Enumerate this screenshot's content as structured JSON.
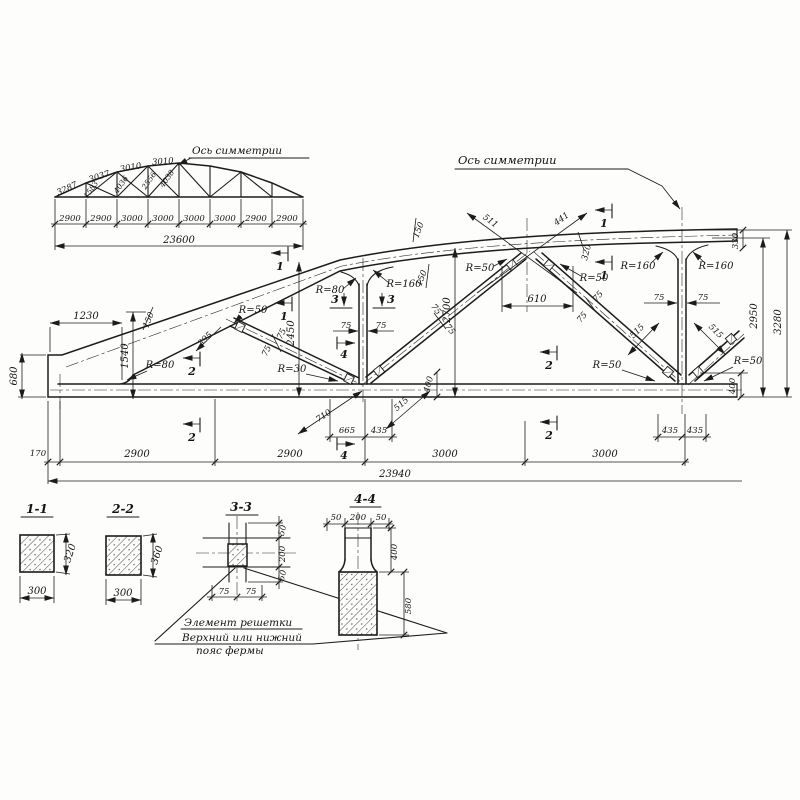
{
  "overview": {
    "axis_label": "Ось симметрии",
    "top_dims": [
      "3287",
      "3037",
      "3010",
      "3010"
    ],
    "diag_dims": [
      "1583",
      "4036",
      "2556",
      "4038"
    ],
    "bottom_dims": [
      "2900",
      "2900",
      "3000",
      "3000",
      "3000",
      "3000",
      "2900",
      "2900"
    ],
    "total": "23600"
  },
  "main": {
    "axis_label": "Ось симметрии",
    "dims": {
      "d1230": "1230",
      "d1540": "1540",
      "d150": "150",
      "d680": "680",
      "d170": "170",
      "d2900": "2900",
      "d3000": "3000",
      "total": "23940",
      "d2450": "2450",
      "d2700": "2700",
      "d2950": "2950",
      "d3280": "3280",
      "d610": "610",
      "d511": "511",
      "d441": "441",
      "d395": "395",
      "d710": "710",
      "d665": "665",
      "d435": "435",
      "d515": "515",
      "d400": "400",
      "d320": "320",
      "d330": "330",
      "d75": "75",
      "r30": "R=30",
      "r50": "R=50",
      "r80": "R=80",
      "r160": "R=160"
    },
    "marks": {
      "s1": "1",
      "s2": "2",
      "s3": "3",
      "s4": "4"
    }
  },
  "sections": {
    "s11": {
      "title": "1-1",
      "w": "300",
      "h": "320"
    },
    "s22": {
      "title": "2-2",
      "w": "300",
      "h": "360"
    },
    "s33": {
      "title": "3-3",
      "d50": "50",
      "d200": "200",
      "d75": "75",
      "note1": "Элемент решетки",
      "note2": "Верхний или нижний",
      "note3": "пояс фермы"
    },
    "s44": {
      "title": "4-4",
      "d50": "50",
      "d200": "200",
      "d400": "400",
      "d580": "580"
    }
  }
}
